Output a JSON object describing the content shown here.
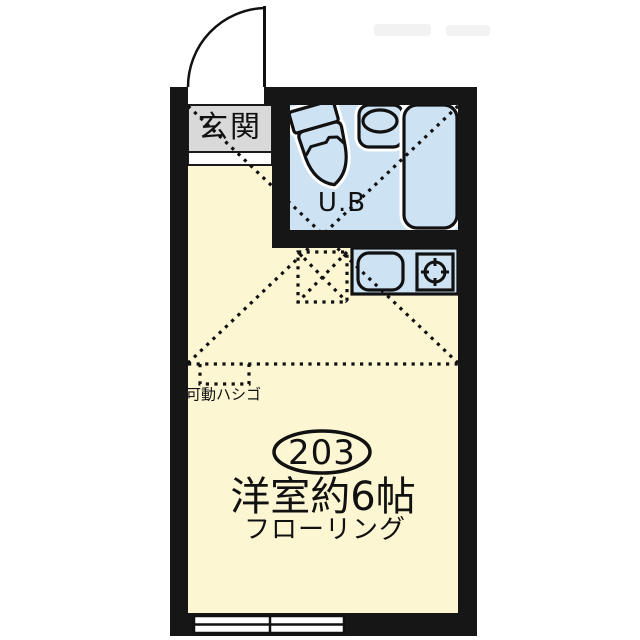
{
  "title": "apartment-floor-plan",
  "unit": {
    "room_number": "203",
    "room_name": "洋室約6帖",
    "floor_type": "フローリング",
    "entrance_label": "玄関",
    "bath_label": "U.B",
    "ladder_label": "可動ハシゴ"
  },
  "colors": {
    "wall": "#161616",
    "floor": "#fcf6d3",
    "bath": "#cde2f3",
    "entrance": "#d9d9d9",
    "ink": "#111111",
    "halo": "#ffffff",
    "watermark": "#f2f2f2"
  },
  "icons": {
    "door": "door-swing-icon",
    "toilet": "toilet-icon",
    "washbasin": "washbasin-icon",
    "bathtub": "bathtub-icon",
    "kitchen_sink": "kitchen-sink-icon",
    "stove": "stove-burner-icon",
    "window": "sliding-window-icon",
    "refrigerator_space": "refrigerator-space-dashed-box",
    "ladder": "ladder-dashed-box",
    "loft": "loft-dashed-x"
  }
}
